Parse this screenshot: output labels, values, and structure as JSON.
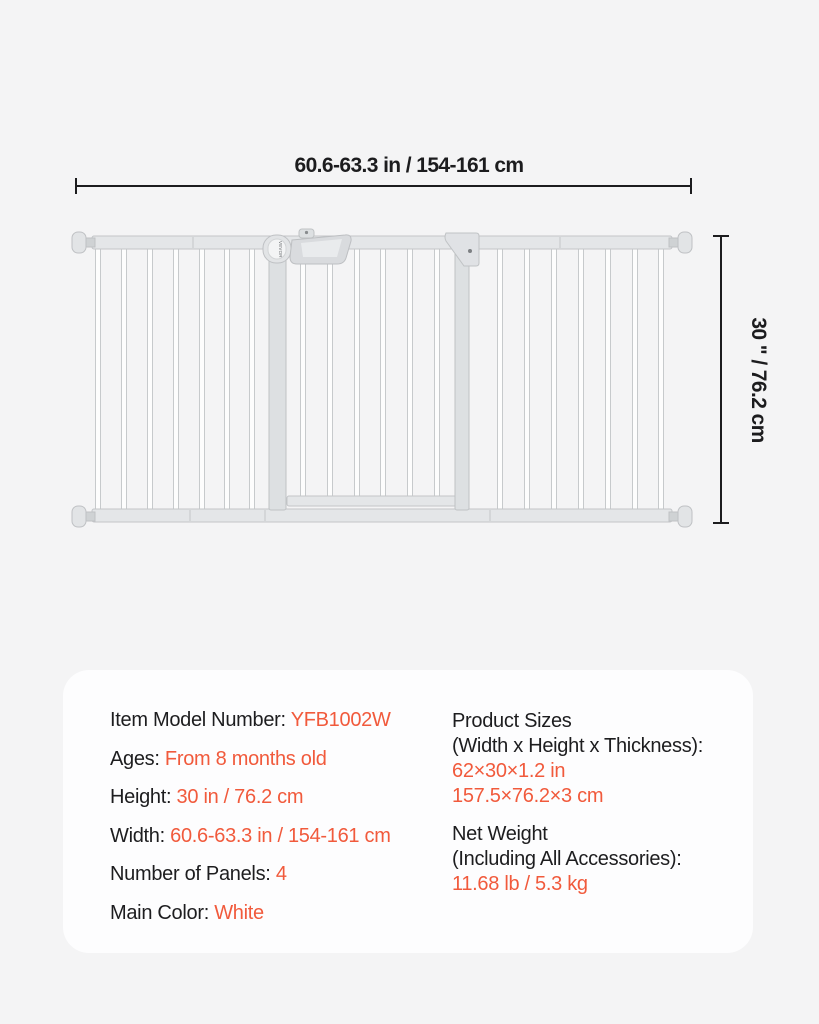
{
  "page": {
    "background_color": "#f4f4f5",
    "accent_color": "#f15a3c",
    "text_color": "#1d1d1f"
  },
  "diagram": {
    "width_dimension_label": "60.6-63.3 in / 154-161 cm",
    "height_dimension_label": "30 \" / 76.2 cm",
    "brand_mark": "VEVOR"
  },
  "spec_card": {
    "left_column": [
      {
        "label": "Item Model Number:",
        "value": "YFB1002W"
      },
      {
        "label": "Ages:",
        "value": "From 8 months old"
      },
      {
        "label": "Height:",
        "value": "30 in / 76.2 cm"
      },
      {
        "label": "Width:",
        "value": "60.6-63.3 in / 154-161 cm"
      },
      {
        "label": "Number of Panels:",
        "value": "4"
      },
      {
        "label": "Main Color:",
        "value": "White"
      }
    ],
    "right_column": [
      {
        "title_line1": "Product Sizes",
        "title_line2": "(Width x Height x Thickness):",
        "value_line1": "62×30×1.2 in",
        "value_line2": "157.5×76.2×3 cm"
      },
      {
        "title_line1": "Net Weight",
        "title_line2": "(Including All Accessories):",
        "value_line1": "11.68 lb / 5.3 kg"
      }
    ]
  }
}
